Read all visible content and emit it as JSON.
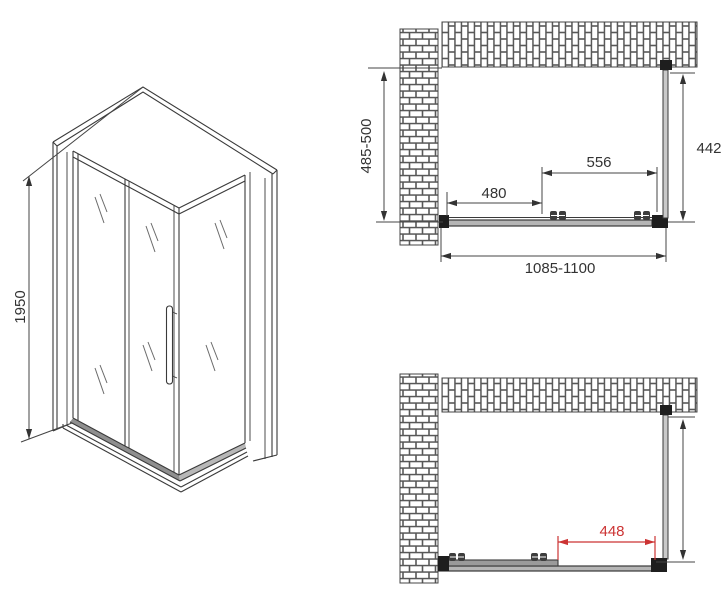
{
  "drawing": {
    "title": "shower-enclosure-technical-drawing",
    "views": {
      "isometric": {
        "height_dim": "1950"
      },
      "plan_closed": {
        "depth_dim": "485-500",
        "side_panel_dim": "442",
        "door_panel_dim": "556",
        "fixed_panel_dim": "480",
        "width_dim": "1085-1100"
      },
      "plan_open": {
        "opening_dim": "448"
      }
    },
    "colors": {
      "line": "#3a3a3a",
      "dimension_text": "#333333",
      "highlight_dimension": "#cc3333",
      "background": "#ffffff"
    }
  }
}
